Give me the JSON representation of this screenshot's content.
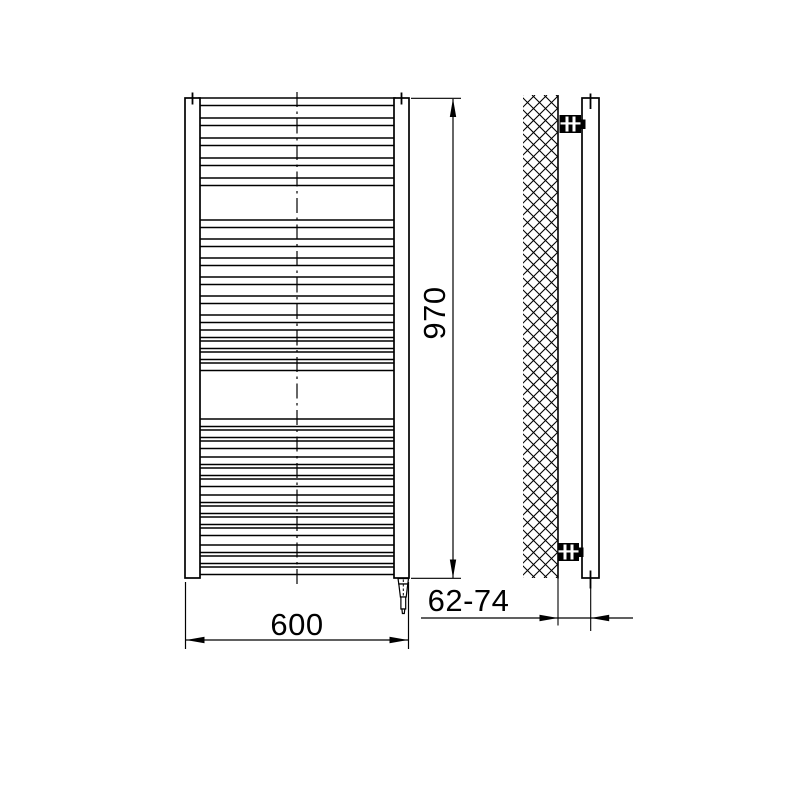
{
  "drawing": {
    "description": "towel-radiator-technical-drawing",
    "line_color": "#000000",
    "background": "#ffffff"
  },
  "labels": {
    "height_dim": "970",
    "width_dim": "600",
    "depth_dim": "62-74"
  },
  "front_view": {
    "rungs": {
      "x": 199,
      "width": 196,
      "thickness": 7.5,
      "group_tops": [
        [
          98,
          118,
          138,
          158,
          178
        ],
        [
          220,
          239,
          258,
          277,
          296,
          315
        ],
        [
          330,
          341,
          352,
          363
        ],
        [
          419,
          430,
          441
        ],
        [
          457,
          468,
          479
        ],
        [
          495,
          506,
          517,
          528
        ],
        [
          545,
          556,
          567
        ]
      ]
    }
  },
  "side_view": {
    "hatch_spacing": 12,
    "hatch_region": {
      "x": 523,
      "y": 95,
      "w": 35,
      "h": 483
    }
  }
}
